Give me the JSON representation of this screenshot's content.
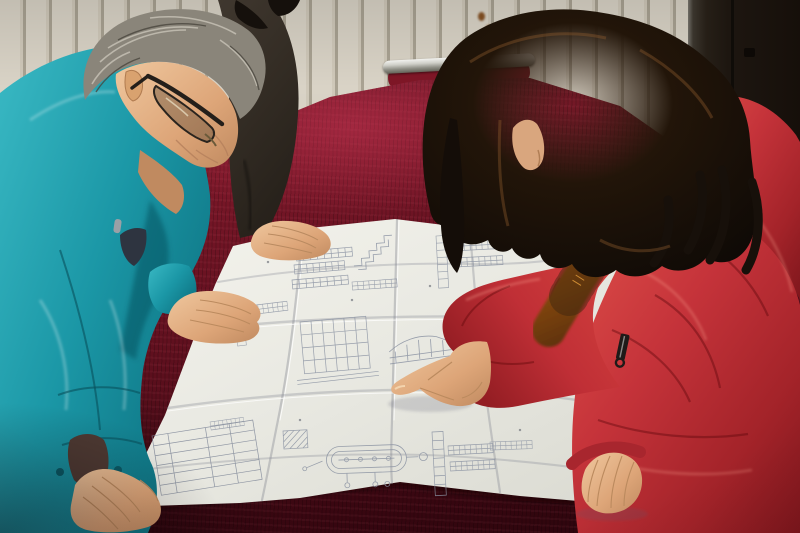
{
  "meta": {
    "title": "Two workers reviewing a construction blueprint on a red velvet table",
    "media_type": "photograph",
    "width_px": 800,
    "height_px": 533,
    "visible_text": "none (blueprint annotations too small to be legible)"
  },
  "scene": {
    "setting": "Indoor room with a cream panelled radiator wall on the left and a dark brown wall or door on the right; a large table draped in crimson velvet fills the foreground",
    "people": [
      {
        "id": "man-left",
        "description": "Middle-aged man with grey hair and dark rectangular glasses, wearing a teal work jacket, leaning over the blueprint with both hands on the table"
      },
      {
        "id": "person-behind",
        "description": "Partially visible second person in a dark grey-brown jacket with black hair, resting one hand on the blueprint"
      },
      {
        "id": "woman-right",
        "description": "Woman with long dark wavy hair wearing a red hooded down coat with orange fur trim, pointing at a detail on the blueprint with her right index finger, left hand resting on the paper"
      }
    ],
    "objects": [
      {
        "id": "blueprint",
        "description": "Large folded white engineering drawing covered in small schematic details, section views, dimension tables and an oval vessel detail"
      },
      {
        "id": "table",
        "description": "Table covered with crimson velvet cloth"
      },
      {
        "id": "chair",
        "description": "Chrome-framed chair with red velvet upholstery just visible behind the table"
      },
      {
        "id": "radiator-wall",
        "description": "Cream wall of vertical radiator panels with small rust stains"
      },
      {
        "id": "dark-wall",
        "description": "Dark brown wall panel on the right side"
      }
    ]
  },
  "palette": {
    "teal_jacket": "#1fa0ae",
    "teal_shadow": "#0c6f7e",
    "velvet_bright": "#8e2136",
    "velvet_mid": "#6d1424",
    "velvet_dark": "#30050e",
    "paper": "#e9e9e2",
    "paper_shadow": "#d4d4cb",
    "blueprint_ink": "#8a92a2",
    "coat_red": "#c5333a",
    "coat_red_highlight": "#e0514a",
    "coat_red_shadow": "#8e1a20",
    "fur_orange": "#cf7d1f",
    "fur_dark": "#46260a",
    "woman_hair": "#1a110b",
    "man_hair_grey": "#9b968a",
    "dark_jacket": "#3c342b",
    "skin": "#e6b488",
    "skin_shadow": "#c08a60",
    "wall_light": "#d7d1c4",
    "wall_groove": "#a9a292",
    "wall_dark": "#1d1610",
    "chrome": "#dcdcd8"
  }
}
